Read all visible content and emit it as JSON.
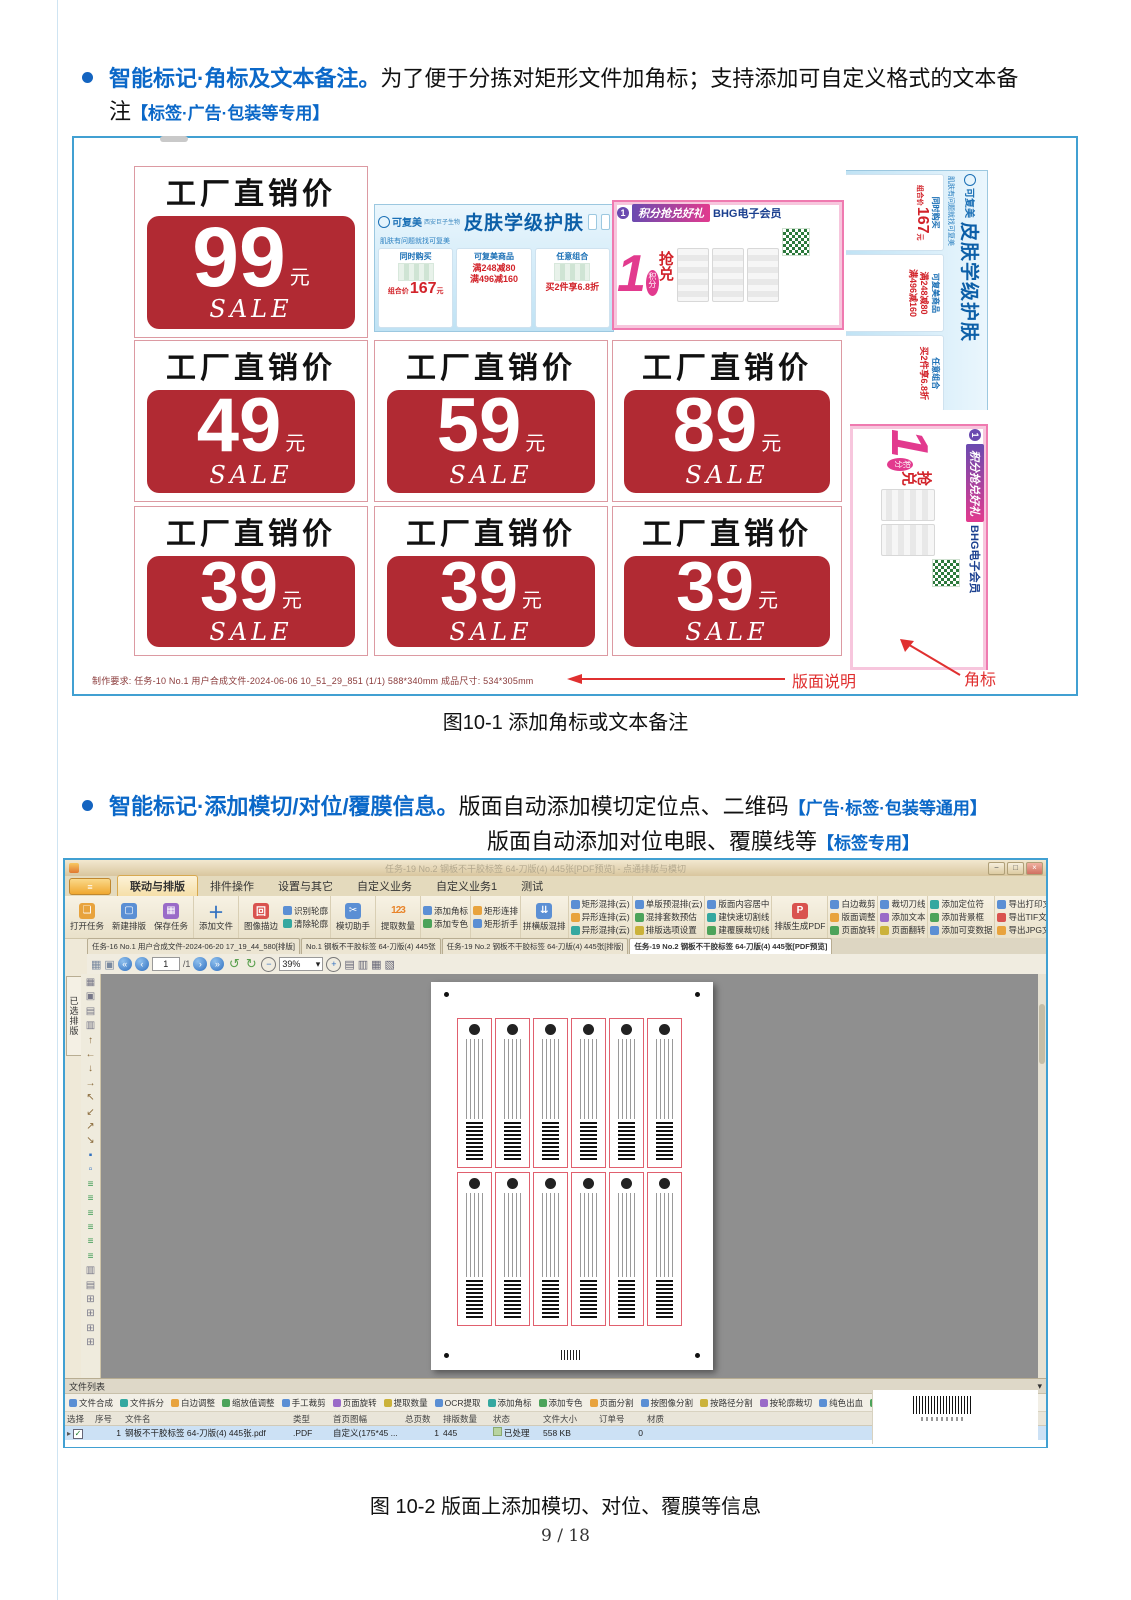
{
  "page": {
    "number": "9  /  18"
  },
  "bullet1": {
    "title": "智能标记·角标及文本备注。",
    "body": "为了便于分拣对矩形文件加角标；支持添加可自定义格式的文本备",
    "body2": "注",
    "tag": "【标签·广告·包装等专用】"
  },
  "figure1": {
    "caption": "图10-1  添加角标或文本备注",
    "price_header": "工厂直销价",
    "unit": "元",
    "sale": "SALE",
    "prices": [
      "99",
      "49",
      "59",
      "89",
      "39",
      "39",
      "39"
    ],
    "blue_ad": {
      "brand": "可复美",
      "brand_sub": "西安巨子生物",
      "title": "皮肤学级护肤",
      "subtitle": "肌肤有问题就找可复美",
      "p1_title": "同时购买",
      "p1_label": "组合价",
      "p1_price": "167",
      "p1_unit": "元",
      "p2_title": "可复美商品",
      "p2_line1": "满248减80",
      "p2_line2": "满496减160",
      "p3_title": "任意组合",
      "p3_deal": "买2件享6.8折"
    },
    "pink_ad": {
      "title": "积分抢兑好礼",
      "member": "BHG电子会员",
      "num": "1",
      "jifen": "积分",
      "qiang": "抢",
      "dui": "兑"
    },
    "footer": "制作要求: 任务-10 No.1 用户合成文件-2024-06-06 10_51_29_851 (1/1) 588*340mm  成品尺寸: 534*305mm",
    "callout_layout": "版面说明",
    "callout_corner": "角标"
  },
  "bullet2": {
    "title": "智能标记·添加模切/对位/覆膜信息。",
    "body": "版面自动添加模切定位点、二维码",
    "tag1": "【广告·标签·包装等通用】",
    "body2": "版面自动添加对位电眼、覆膜线等",
    "tag2": "【标签专用】"
  },
  "figure2": {
    "caption": "图 10-2 版面上添加模切、对位、覆膜等信息",
    "window_title": "任务-19 No.2 钢板不干胶标签 64-刀版(4) 445张[PDF预览] - 点通排版与模切",
    "window_buttons": {
      "min": "−",
      "max": "□",
      "close": "×"
    },
    "app_button": "≡",
    "ribbon_tabs": [
      "联动与排版",
      "排件操作",
      "设置与其它",
      "自定义业务",
      "自定义业务1",
      "测试"
    ],
    "ribbon_groups": [
      {
        "items": [
          "打开任务",
          "新建排版",
          "保存任务"
        ]
      },
      {
        "items": [
          "添加文件"
        ]
      },
      {
        "items": [
          "图像描边",
          "识别轮廓",
          "清除轮廓"
        ]
      },
      {
        "items": [
          "模切助手"
        ]
      },
      {
        "items": [
          "提取数量"
        ]
      },
      {
        "items": [
          "添加角标",
          "添加专色"
        ]
      },
      {
        "items": [
          "矩形连排",
          "矩形折手"
        ]
      },
      {
        "items": [
          "拼横版混排"
        ]
      },
      {
        "items": [
          "矩形混排(云)",
          "异形连排(云)",
          "异形混排(云)"
        ]
      },
      {
        "items": [
          "单版预混排(云)",
          "混排套数预估",
          "排版选项设置"
        ]
      },
      {
        "items": [
          "版面内容居中",
          "建快速切割线",
          "建覆膜裁切线"
        ]
      },
      {
        "items": [
          "排版生成PDF"
        ]
      },
      {
        "items": [
          "白边裁剪",
          "版面调整",
          "页面旋转"
        ]
      },
      {
        "items": [
          "裁切刀线",
          "添加文本",
          "页面翻转"
        ]
      },
      {
        "items": [
          "添加定位符",
          "添加背景框",
          "添加可变数据"
        ]
      },
      {
        "items": [
          "导出打印文件",
          "导出TIF文件",
          "导出JPG文件"
        ]
      },
      {
        "items": [
          "导出PDF指令(无图层)",
          "导出PDF指令(带图层)"
        ]
      },
      {
        "items": [
          "导出PLT指令",
          "导出DXF指令",
          "导出CF2指令"
        ]
      },
      {
        "items": [
          "另存为PDF"
        ]
      }
    ],
    "big_icons": {
      "open": "❏",
      "new": "▢",
      "save": "▦",
      "add": "＋",
      "stroke": "回",
      "diecut": "✂",
      "count": "123",
      "mix": "⇊",
      "pdf": "P",
      "saveas": "P"
    },
    "doc_tabs": [
      "任务-16 No.1 用户合成文件-2024-06-20 17_19_44_580[排版]",
      "No.1 钢板不干胶标签 64-刀版(4) 445张",
      "任务-19 No.2 钢板不干胶标签 64-刀版(4) 445张[排版]",
      "任务-19 No.2 钢板不干胶标签 64-刀版(4) 445张[PDF预览]"
    ],
    "nav": {
      "first": "«",
      "prev": "‹",
      "page": "1",
      "page_total": "/1",
      "next": "›",
      "last": "»",
      "rot_l": "↺",
      "rot_r": "↻",
      "zoom_out": "−",
      "zoom": "39%",
      "zoom_dd": "▾",
      "zoom_in": "+",
      "grid1": "▦",
      "grid2": "▣",
      "views": [
        "▤",
        "▥",
        "▦",
        "▧"
      ]
    },
    "side_tab": "已选排版",
    "strip_icons": [
      "▦",
      "▣",
      "▤",
      "▥",
      "↑",
      "←",
      "↓",
      "→",
      "↖",
      "↙",
      "↗",
      "↘",
      "▪",
      "▫",
      "≡",
      "≡",
      "≡",
      "≡",
      "≡",
      "≡",
      "▥",
      "▤",
      "⊞",
      "⊞",
      "⊞",
      "⊞"
    ],
    "file_panel": {
      "title": "文件列表",
      "collapse": "▾",
      "tools": [
        "文件合成",
        "文件拆分",
        "白边调整",
        "缩放值调整",
        "手工裁剪",
        "页面旋转",
        "提取数量",
        "OCR提取",
        "添加角标",
        "添加专色",
        "页面分割",
        "按图像分割",
        "按路径分割",
        "按轮廓裁切",
        "纯色出血",
        "镜像出血",
        "刀线合并"
      ],
      "columns": [
        "选择",
        "序号",
        "文件名",
        "类型",
        "首页图幅",
        "总页数",
        "排版数量",
        "状态",
        "文件大小",
        "订单号",
        "材质"
      ],
      "row": {
        "check": "✓",
        "seq": "1",
        "name": "钢板不干胶标签 64-刀版(4) 445张.pdf",
        "type": ".PDF",
        "spec": "自定义(175*45 ...",
        "pages": "1",
        "count": "445",
        "status": "已处理",
        "size": "558 KB",
        "order": "0"
      }
    }
  }
}
